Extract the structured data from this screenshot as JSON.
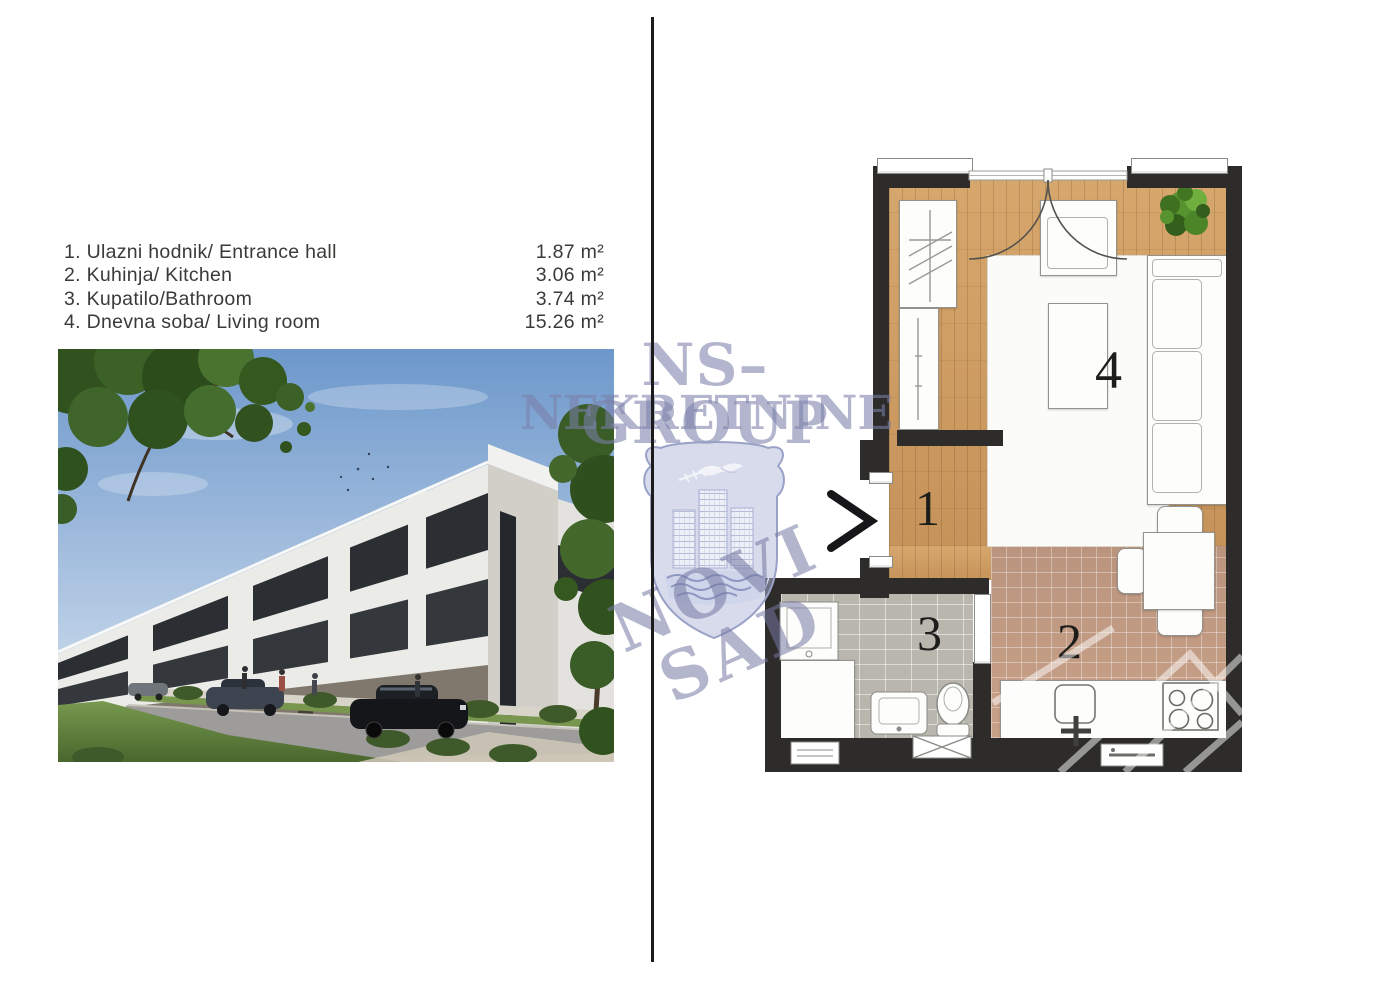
{
  "room_list": {
    "items": [
      {
        "label": "1. Ulazni hodnik/ Entrance hall",
        "area": "1.87 m²"
      },
      {
        "label": "2. Kuhinja/ Kitchen",
        "area": "3.06 m²"
      },
      {
        "label": "3. Kupatilo/Bathroom",
        "area": "3.74 m²"
      },
      {
        "label": "4. Dnevna soba/ Living room",
        "area": "15.26 m²"
      }
    ]
  },
  "watermark": {
    "brand_line1": "NS–GROUP",
    "brand_line2": "NEKRETNINE",
    "city": "NOVI SAD",
    "color": "#7a7fa8"
  },
  "floorplan": {
    "labels": {
      "entrance_hall": "1",
      "kitchen": "2",
      "bathroom": "3",
      "living_room": "4"
    },
    "colors": {
      "wall": "#2d2c2a",
      "wood_floor": "#cd9c62",
      "kitchen_tile": "#c9a189",
      "bathroom_tile": "#b8b6ad"
    }
  }
}
